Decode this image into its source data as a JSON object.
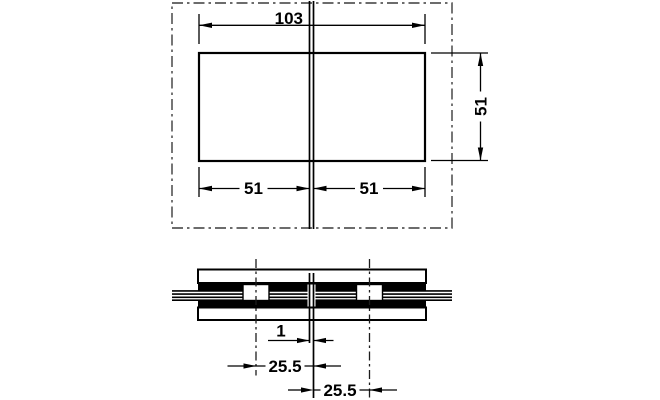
{
  "drawing": {
    "background": "#ffffff",
    "line_color": "#000000",
    "phantom_color": "#3c3c3c",
    "labels": {
      "overall_width": "103",
      "height": "51",
      "left_half": "51",
      "right_half": "51",
      "glass_gap": "1",
      "offset_left": "25.5",
      "offset_right": "25.5"
    }
  }
}
